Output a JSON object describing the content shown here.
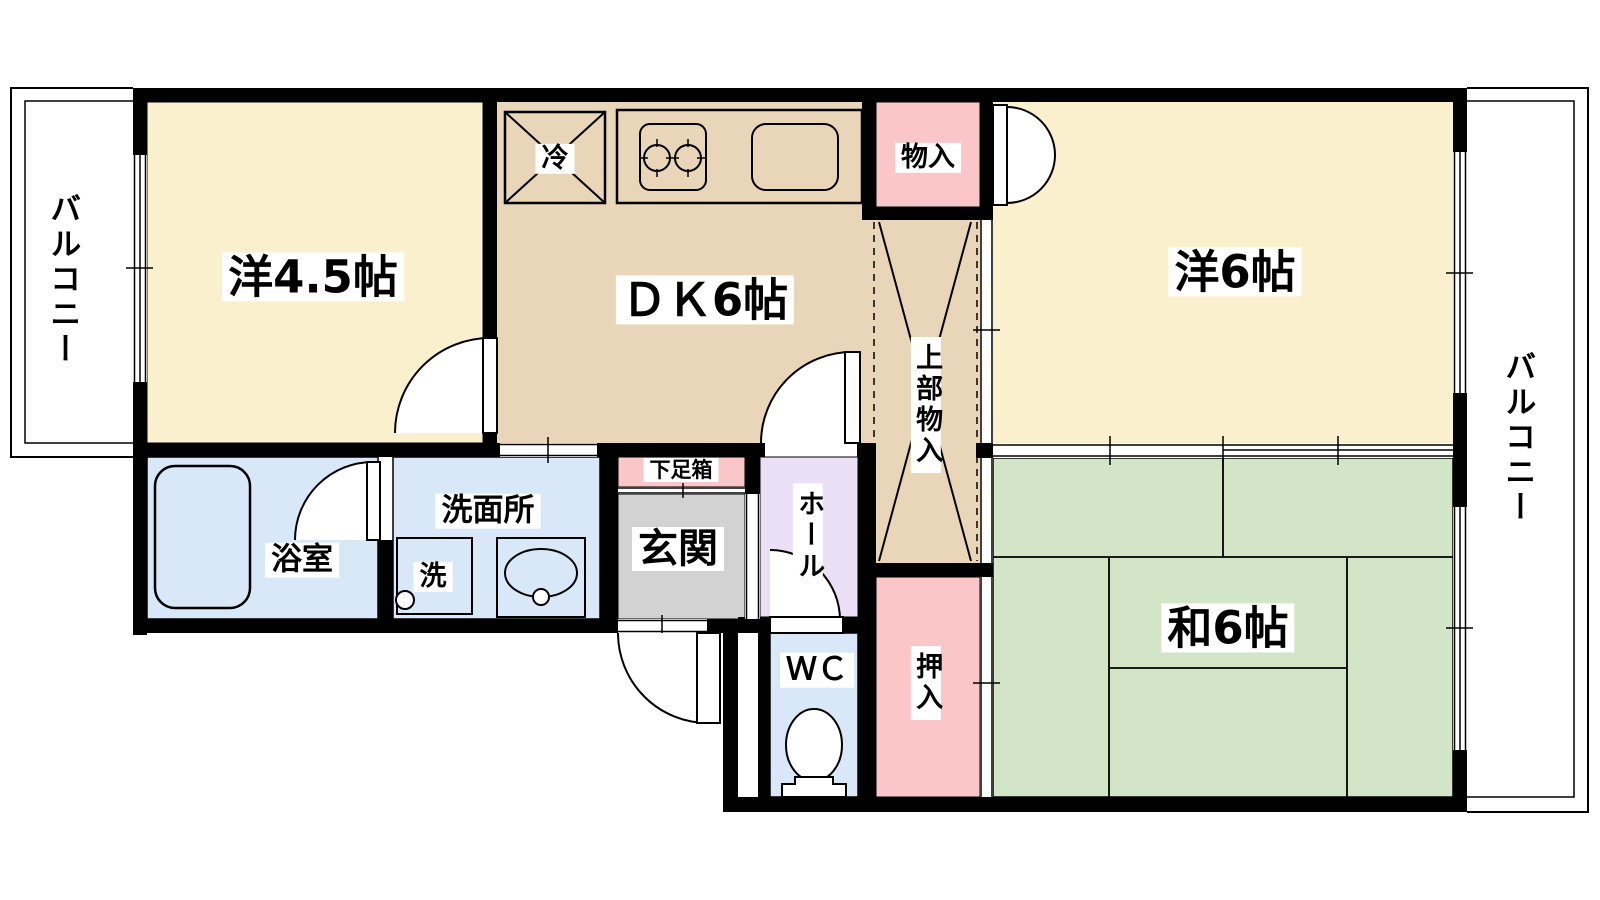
{
  "palette": {
    "wall": "#000000",
    "cream": "#FBF0CE",
    "tan": "#E9D6B8",
    "pink": "#FAC6C8",
    "green": "#D2E5C6",
    "blue": "#D8E8F9",
    "purple": "#EADFF5",
    "gray": "#D2D2D2",
    "white": "#FFFFFF"
  },
  "floorplan": {
    "balcony_left": "バルコニー",
    "balcony_right": "バルコニー",
    "rooms": {
      "western_4_5": "洋4.5帖",
      "dining_kitchen": "ＤＫ6帖",
      "western_6": "洋6帖",
      "japanese_6": "和6帖",
      "bathroom": "浴室",
      "washroom": "洗面所",
      "entrance": "玄関",
      "hall": "ホール",
      "toilet": "ＷＣ"
    },
    "storage": {
      "storage_closet": "物入",
      "upper_storage": "上部物入",
      "futon_closet": "押入",
      "shoe_box": "下足箱"
    },
    "fixtures": {
      "refrigerator": "冷",
      "washing_machine": "洗"
    }
  }
}
